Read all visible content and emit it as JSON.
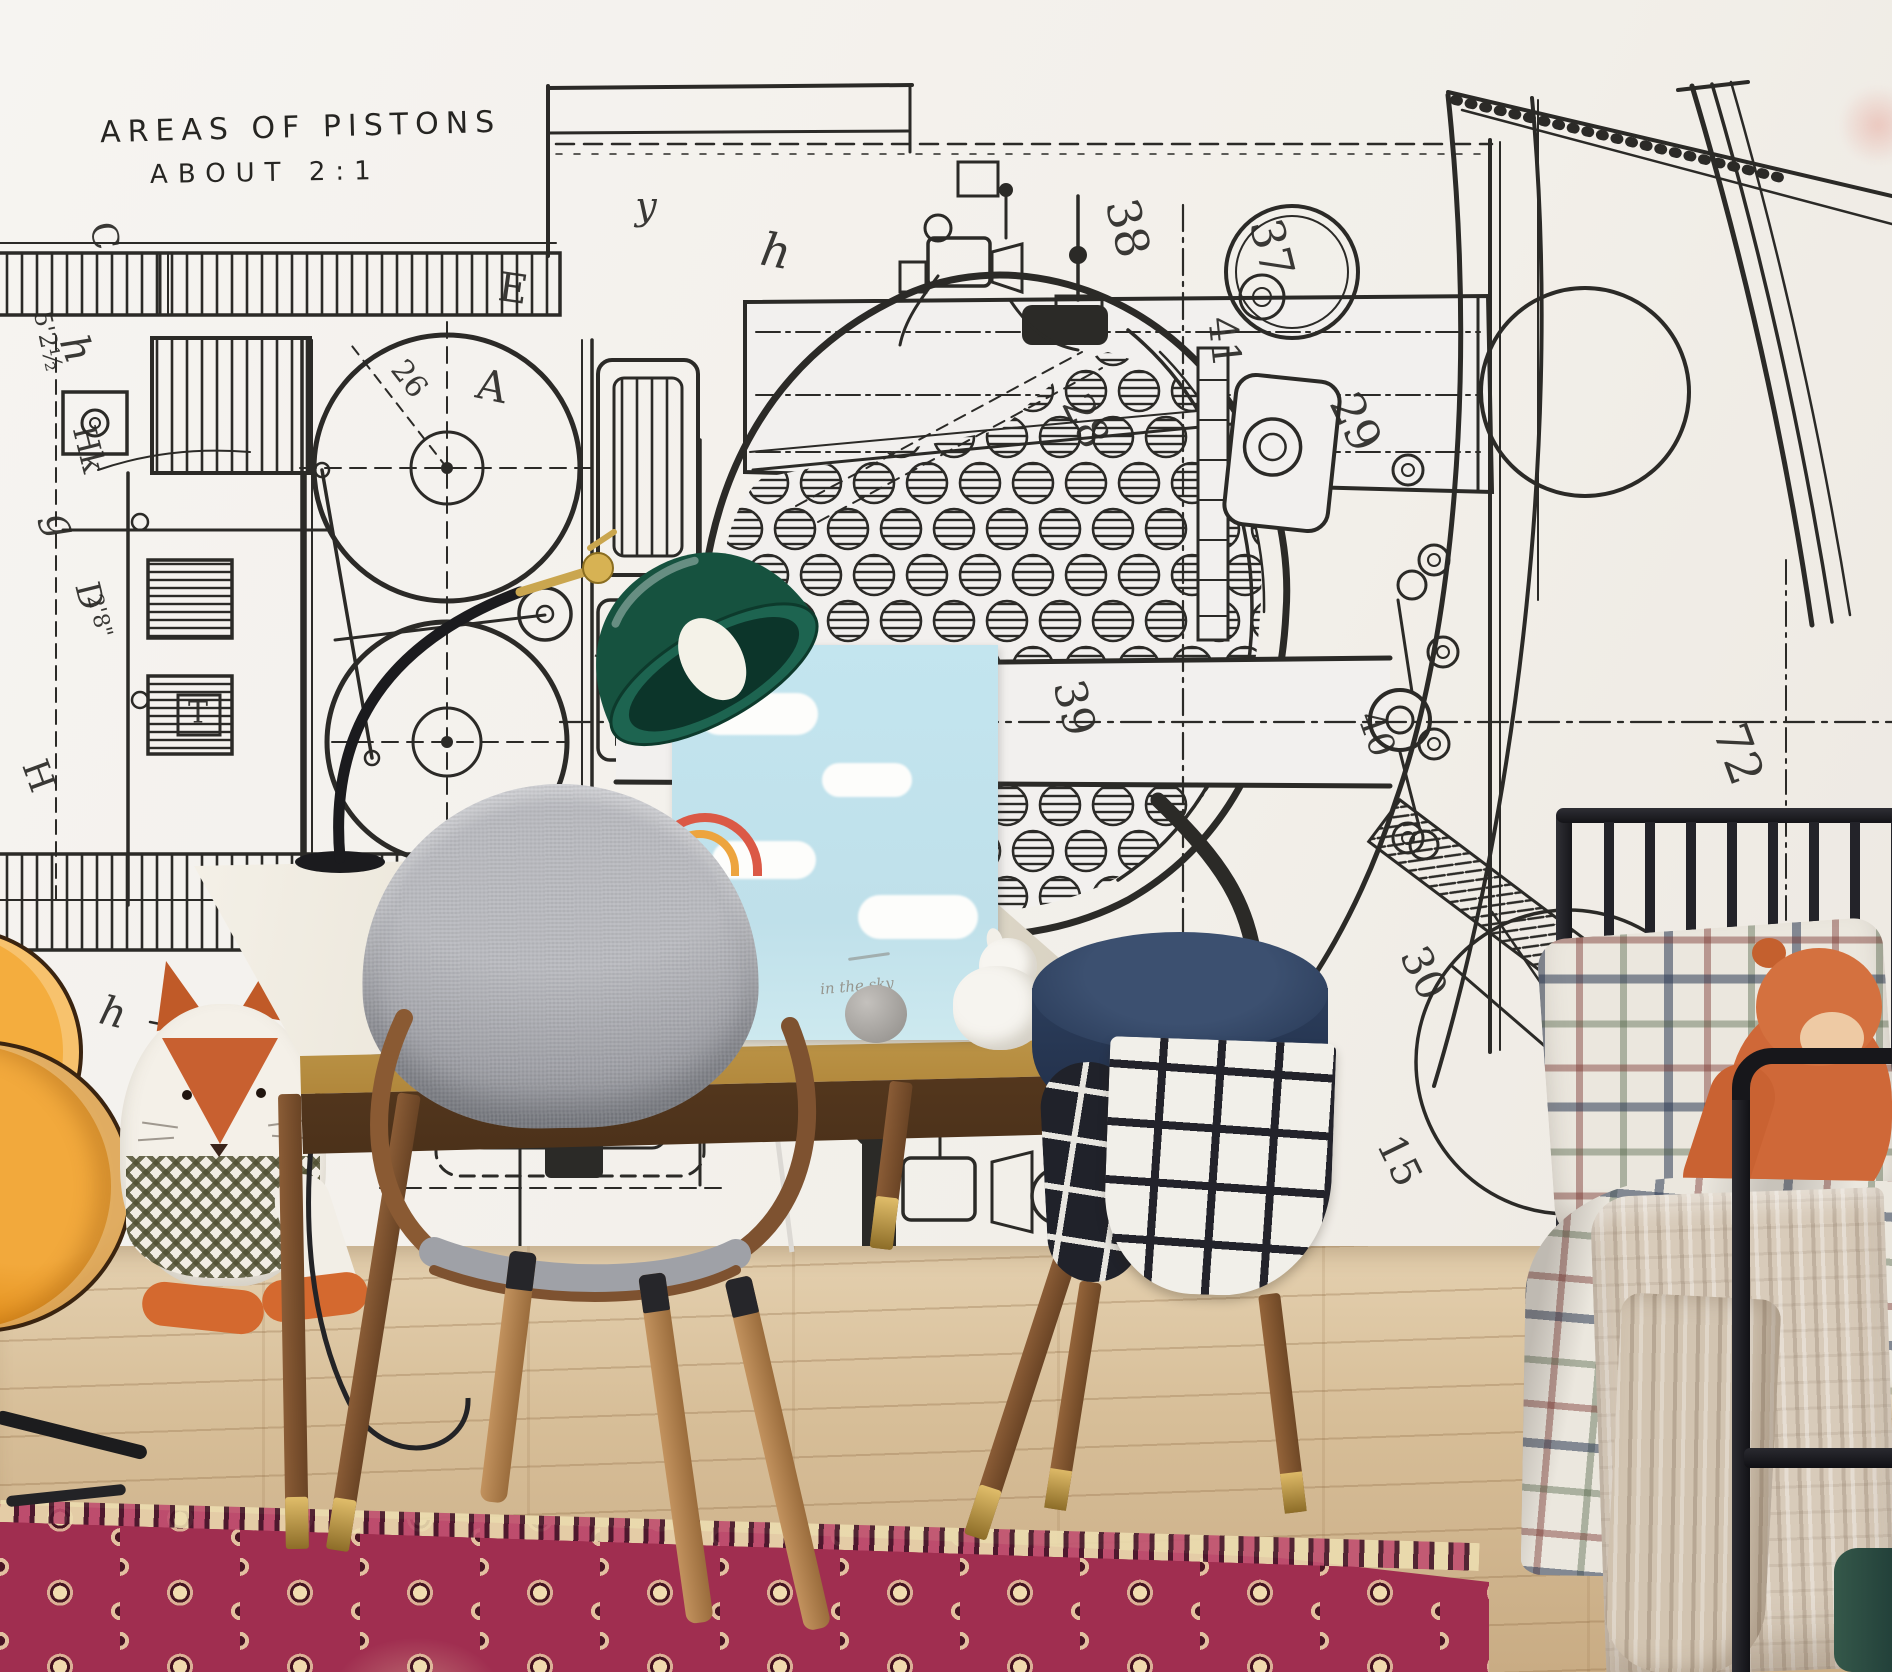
{
  "room": {
    "wall_color": "#f3f1ed",
    "floor_color": "#d3b995",
    "rug_color": "#9e2b4d"
  },
  "mural": {
    "ink_color": "#2b2a27",
    "heading": {
      "line1": "AREAS OF PISTONS",
      "line2": "ABOUT 2:1"
    },
    "labels": [
      {
        "t": "38",
        "x": 1128,
        "y": 228,
        "r": 76,
        "s": 46
      },
      {
        "t": "37",
        "x": 1272,
        "y": 248,
        "r": 76,
        "s": 46
      },
      {
        "t": "41",
        "x": 1224,
        "y": 342,
        "r": 84,
        "s": 40
      },
      {
        "t": "28",
        "x": 1086,
        "y": 421,
        "r": 64,
        "s": 42
      },
      {
        "t": "29",
        "x": 1356,
        "y": 422,
        "r": 64,
        "s": 46
      },
      {
        "t": "39",
        "x": 1074,
        "y": 708,
        "r": 76,
        "s": 44
      },
      {
        "t": "40",
        "x": 1376,
        "y": 734,
        "r": 70,
        "s": 36
      },
      {
        "t": "72",
        "x": 1738,
        "y": 754,
        "r": 70,
        "s": 48
      },
      {
        "t": "30",
        "x": 1424,
        "y": 973,
        "r": 64,
        "s": 42
      },
      {
        "t": "22",
        "x": 1164,
        "y": 983,
        "r": 76,
        "s": 44
      },
      {
        "t": "38",
        "x": 1126,
        "y": 1192,
        "r": 72,
        "s": 44
      },
      {
        "t": "15",
        "x": 1399,
        "y": 1161,
        "r": 64,
        "s": 40
      },
      {
        "t": "26",
        "x": 409,
        "y": 379,
        "r": 52,
        "s": 30
      },
      {
        "t": "5⅛",
        "x": 903,
        "y": 1004,
        "r": 74,
        "s": 26
      },
      {
        "t": "5'2½",
        "x": 48,
        "y": 341,
        "r": 78,
        "s": 24
      },
      {
        "t": "2'8\"",
        "x": 99,
        "y": 616,
        "r": 75,
        "s": 22
      },
      {
        "t": "y",
        "x": 646,
        "y": 206,
        "r": 0,
        "s": 38,
        "i": 1
      },
      {
        "t": "E",
        "x": 513,
        "y": 289,
        "r": 8,
        "s": 40
      },
      {
        "t": "A",
        "x": 492,
        "y": 386,
        "r": 12,
        "s": 42
      },
      {
        "t": "B",
        "x": 611,
        "y": 649,
        "r": 22,
        "s": 40
      },
      {
        "t": "h",
        "x": 776,
        "y": 251,
        "r": 10,
        "s": 46,
        "i": 1
      },
      {
        "t": "a₁",
        "x": 686,
        "y": 906,
        "r": 8,
        "s": 30,
        "i": 1
      },
      {
        "t": "C",
        "x": 104,
        "y": 236,
        "r": 80,
        "s": 36
      },
      {
        "t": "h",
        "x": 76,
        "y": 349,
        "r": 70,
        "s": 40,
        "i": 1
      },
      {
        "t": "Hk",
        "x": 89,
        "y": 449,
        "r": 76,
        "s": 32
      },
      {
        "t": "g",
        "x": 61,
        "y": 524,
        "r": 70,
        "s": 40,
        "i": 1
      },
      {
        "t": "D",
        "x": 89,
        "y": 596,
        "r": 76,
        "s": 34
      },
      {
        "t": "H",
        "x": 38,
        "y": 776,
        "r": 70,
        "s": 36
      },
      {
        "t": "T",
        "x": 198,
        "y": 713,
        "r": 0,
        "s": 30
      },
      {
        "t": "h",
        "x": 113,
        "y": 1013,
        "r": 14,
        "s": 40,
        "i": 1
      },
      {
        "t": "C",
        "x": 129,
        "y": 1153,
        "r": 14,
        "s": 36
      },
      {
        "t": "G",
        "x": 283,
        "y": 1193,
        "r": 18,
        "s": 38
      }
    ]
  },
  "desk": {
    "top_color": "#ece7db",
    "trim_color": "#c9a457",
    "wood_color": "#7b5132"
  },
  "lamp": {
    "shade_color": "#1a5a49",
    "arm_color": "#1d1d20",
    "accent_color": "#c9a84c"
  },
  "canvas_print": {
    "caption": "in the sky",
    "sky_color": "#bfe2ec"
  },
  "chair": {
    "fabric_color": "#a0a2a8",
    "wood_color": "#8a5a33"
  },
  "stool": {
    "color": "#2c3d5e"
  },
  "bed": {
    "frame_color": "#1d1d21"
  },
  "textiles": {
    "plaid_base": "#ece8df",
    "knit_color": "#d7cab8",
    "grid_blanket": "#f2f0ea"
  },
  "toys": {
    "guitar_color": "#e8921c",
    "fox_accent": "#c4612c"
  }
}
